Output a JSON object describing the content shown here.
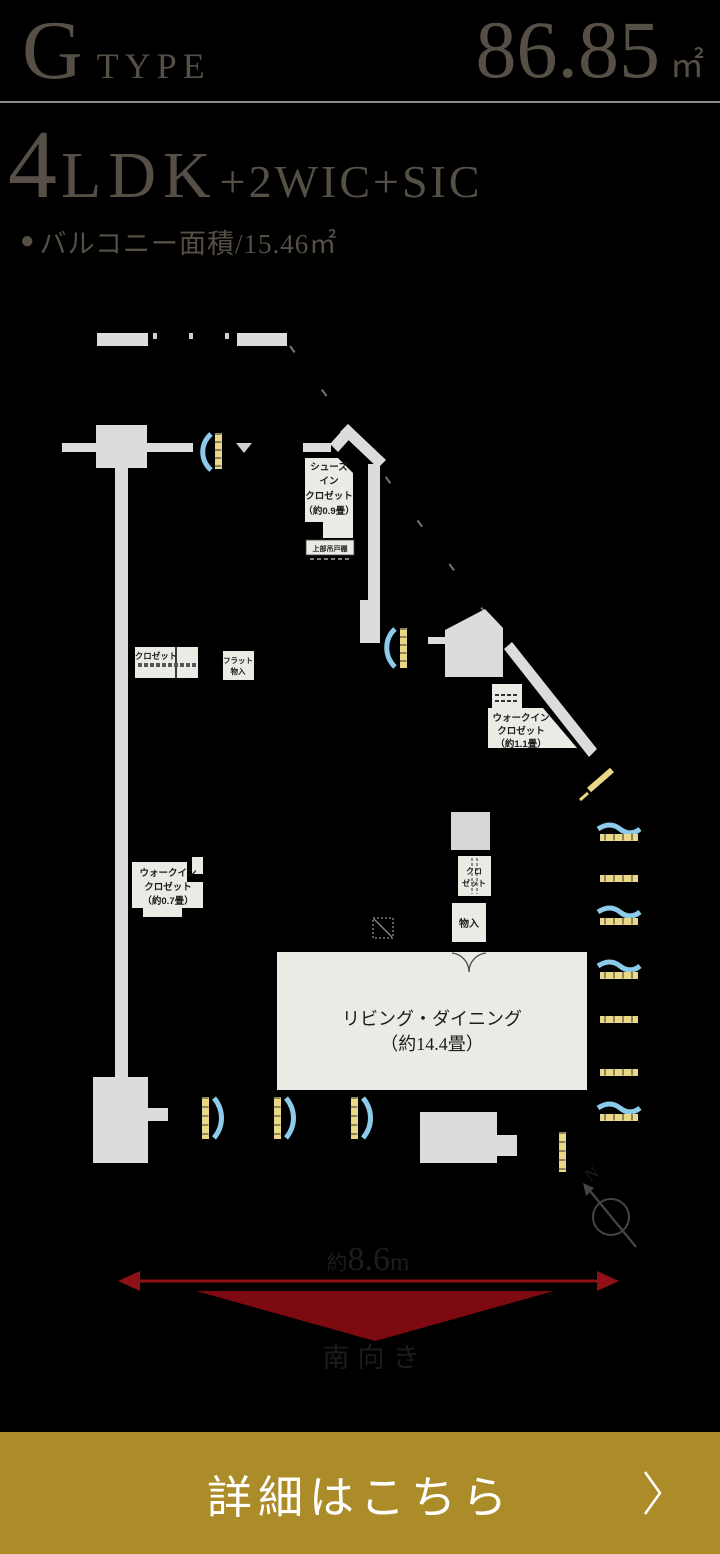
{
  "header": {
    "type_letter": "G",
    "type_word": "TYPE",
    "area_value": "86.85",
    "area_unit": "㎡"
  },
  "layout": {
    "rooms_number": "4",
    "rooms_type": "LDK",
    "rooms_suffix": "+2WIC+SIC",
    "balcony_bullet": "●",
    "balcony_label": "バルコニー面積/15.46㎡"
  },
  "plan": {
    "shoes_closet": {
      "line1": "シューズ",
      "line2": "イン",
      "line3": "クロゼット",
      "line4": "（約0.9畳）"
    },
    "upper_cabinet": "上部吊戸棚",
    "closet1": "クロゼット",
    "flat_storage": {
      "line1": "フラット",
      "line2": "物入"
    },
    "wic11": {
      "line1": "ウォークイン",
      "line2": "クロゼット",
      "line3": "（約1.1畳）"
    },
    "wic07": {
      "line1": "ウォークイン",
      "line2": "クロゼット",
      "line3": "（約0.7畳）"
    },
    "closet2": {
      "line1": "クロ",
      "line2": "ゼット"
    },
    "storage": "物入",
    "living": {
      "line1": "リビング・ダイニング",
      "line2": "（約14.4畳）"
    },
    "compass_n": "N"
  },
  "dimension": {
    "prefix": "約",
    "value": "8.6",
    "unit": "m",
    "direction": "南向き"
  },
  "cta": {
    "label": "詳細はこちら"
  },
  "colors": {
    "background": "#000000",
    "heading_text": "#564f46",
    "divider": "#8a8a8a",
    "wall": "#dcdddb",
    "room": "#e9ebe5",
    "window_blue": "#8ccbe9",
    "window_yellow": "#ead886",
    "accent_red": "#8e1117",
    "triangle_red": "#7c0a10",
    "cta_gold": "#ac8b29",
    "compass_gray": "#454545"
  }
}
